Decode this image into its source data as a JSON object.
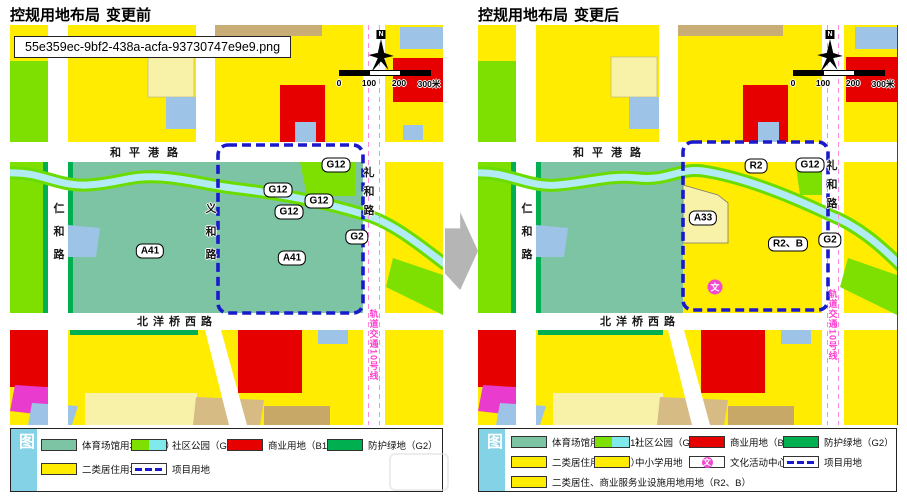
{
  "page": {
    "title_before_prefix": "控规用地布局",
    "title_before_suffix": "变更前",
    "title_after_prefix": "控规用地布局",
    "title_after_suffix": "变更后",
    "filename_overlay": "55e359ec-9bf2-438a-acfa-93730747e9e9.png"
  },
  "maps": {
    "before": {
      "roads": {
        "heping_gang": "和平港路",
        "renhe": "仁和路",
        "yihe": "义和路",
        "lihe": "礼和路",
        "beiyangqiao_xi": "北洋桥西路"
      },
      "rail_line": "轨道交通10号线",
      "zone_labels": {
        "a41_west": "A41",
        "a41_site": "A41",
        "g12_block": "G12",
        "g12_river_a": "G12",
        "g12_river_b": "G12",
        "g12_river_c": "G12",
        "g2": "G2"
      },
      "north_label": "N",
      "scale_ticks": [
        "0",
        "100",
        "200",
        "300米"
      ]
    },
    "after": {
      "roads": {
        "heping_gang": "和平港路",
        "renhe": "仁和路",
        "lihe": "礼和路",
        "beiyangqiao_xi": "北洋桥西路"
      },
      "rail_line": "轨道交通10号线",
      "zone_labels": {
        "r2": "R2",
        "g12_block": "G12",
        "a33": "A33",
        "r2_b": "R2、B",
        "g2": "G2"
      },
      "culture_marker": "文",
      "north_label": "N",
      "scale_ticks": [
        "0",
        "100",
        "200",
        "300米"
      ]
    }
  },
  "legends": {
    "before": {
      "title": "图例",
      "items": [
        {
          "swatch": "teal",
          "label": "体育场馆用地（A41）"
        },
        {
          "swatch": "split",
          "label": "社区公园（G12）"
        },
        {
          "swatch": "red",
          "label": "商业用地（B1）"
        },
        {
          "swatch": "dgreen",
          "label": "防护绿地（G2）"
        },
        {
          "swatch": "yellow",
          "label": "二类居住用地（R2）"
        },
        {
          "swatch": "dashed",
          "label": "项目用地"
        }
      ]
    },
    "after": {
      "title": "图例",
      "culture_char": "文",
      "items": [
        {
          "swatch": "teal",
          "label": "体育场馆用地（A41）"
        },
        {
          "swatch": "split",
          "label": "社区公园（G12）"
        },
        {
          "swatch": "red",
          "label": "商业用地（B1）"
        },
        {
          "swatch": "dgreen",
          "label": "防护绿地（G2）"
        },
        {
          "swatch": "yellow",
          "label": "二类居住用地（R2）"
        },
        {
          "swatch": "yellow2",
          "label": "中小学用地（A33）"
        },
        {
          "swatch": "culture",
          "label": "文化活动中心"
        },
        {
          "swatch": "dashed",
          "label": "项目用地"
        },
        {
          "swatch": "yellow3",
          "label": "二类居住、商业服务业设施用地用地（R2、B）"
        }
      ]
    }
  },
  "colors": {
    "residential_yellow": "#ffec00",
    "sports_teal": "#7cc4a4",
    "park_green": "#7de000",
    "park_cyan": "#80e9ec",
    "commercial_red": "#e60000",
    "protective_green": "#00b050",
    "school_pale_yellow": "#f7f2a8",
    "river_cyan": "#b2ebf3",
    "parcel_blue": "#9dc3e6",
    "parcel_magenta": "#ea3bcf",
    "parcel_tan": "#d6bb85",
    "rail_pink": "#ff3fd0",
    "boundary_blue": "#1a1acc",
    "arrow_gray": "#b5b5b5",
    "legend_strip_blue": "#84d2e6"
  }
}
